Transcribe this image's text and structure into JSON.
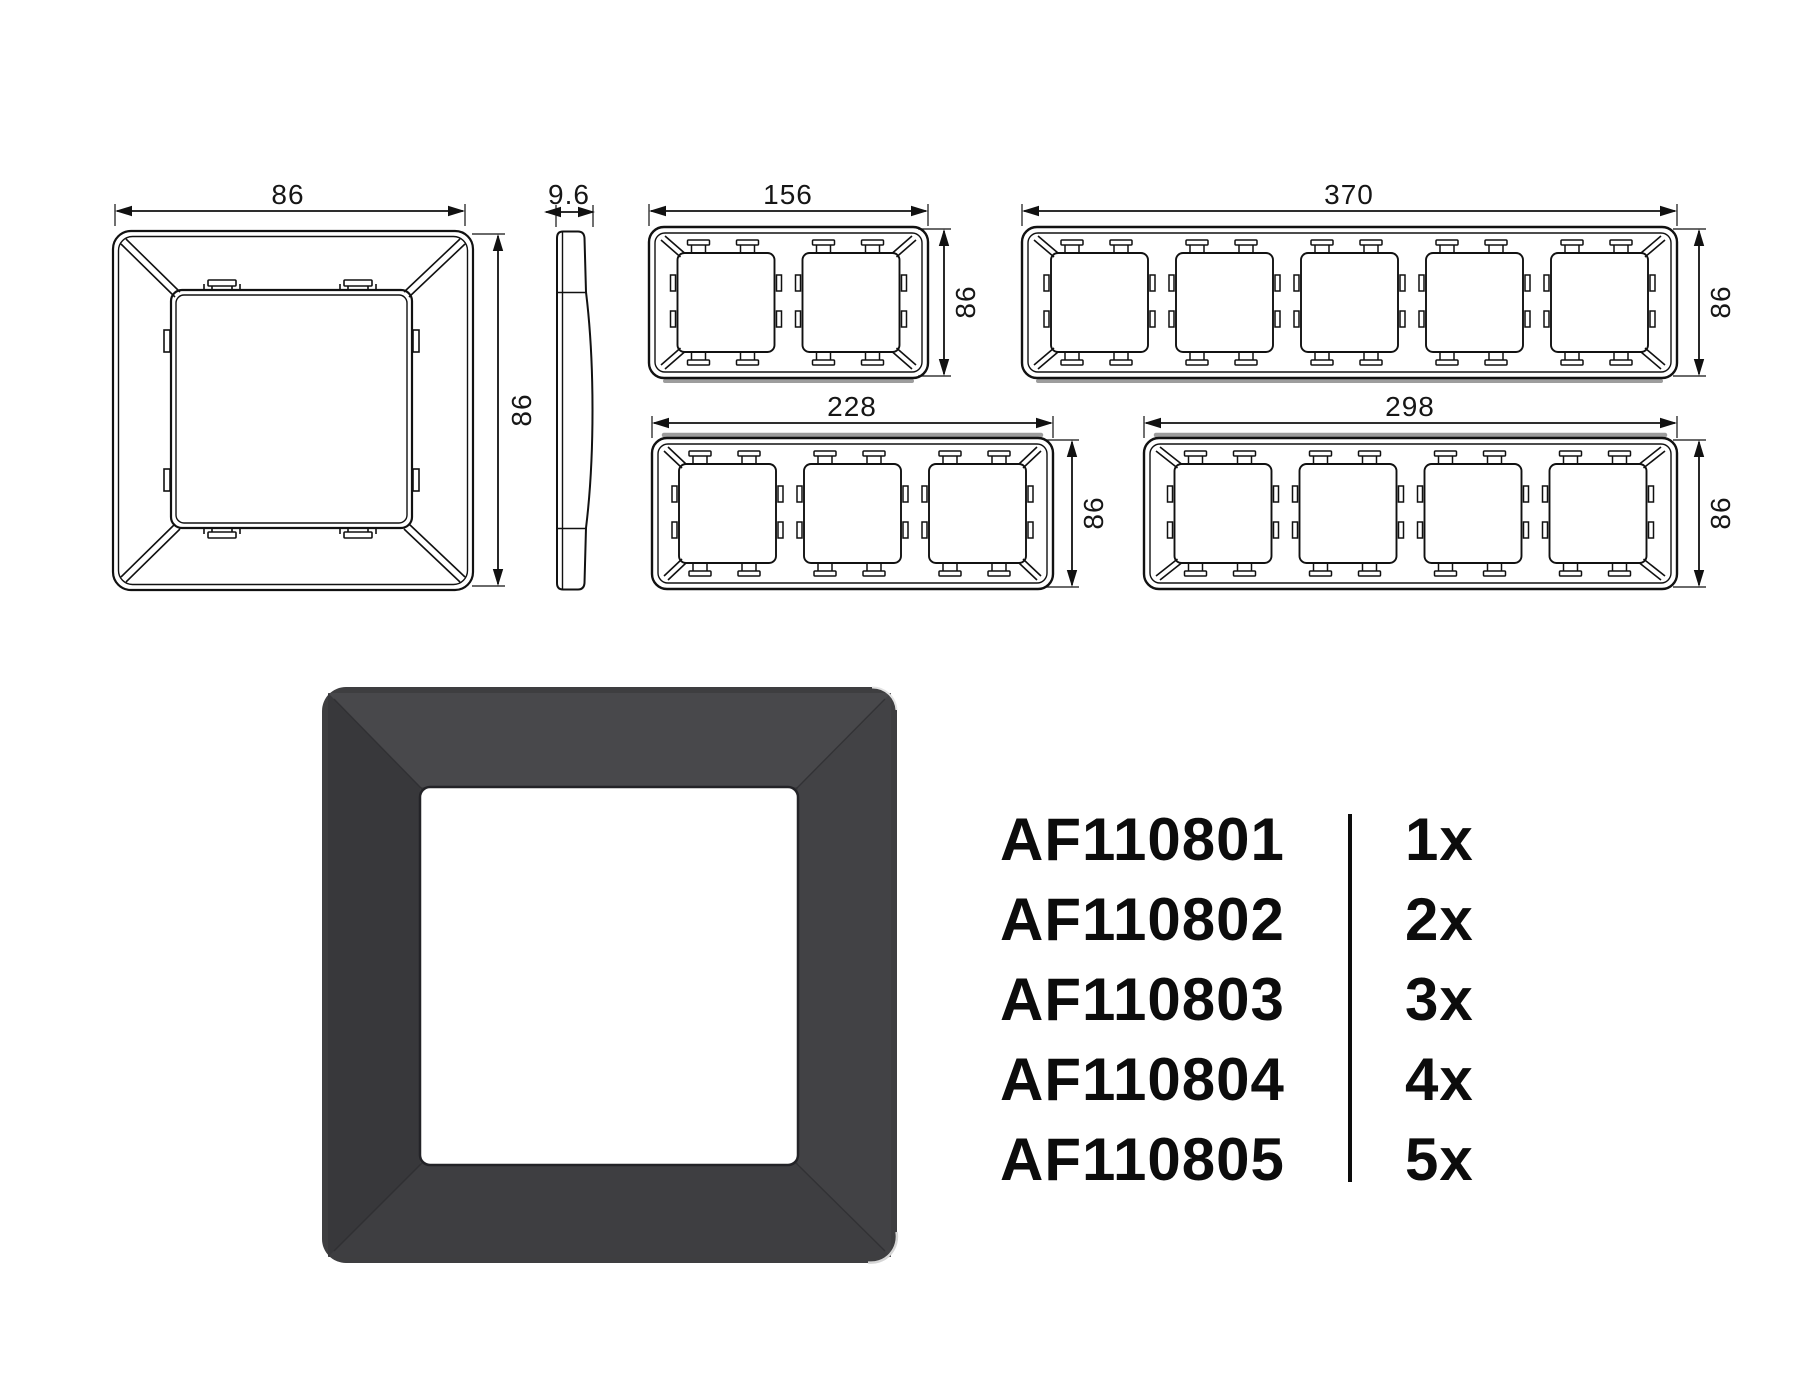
{
  "drawings": {
    "front_view": {
      "width_label": "86",
      "height_label": "86"
    },
    "side_view": {
      "depth_label": "9.6"
    },
    "frame_2gang": {
      "width_label": "156",
      "height_label": "86"
    },
    "frame_3gang": {
      "width_label": "228",
      "height_label": "86"
    },
    "frame_4gang": {
      "width_label": "298",
      "height_label": "86"
    },
    "frame_5gang": {
      "width_label": "370",
      "height_label": "86"
    }
  },
  "render": {
    "frame_color": "#3e3e40",
    "opening_color": "#ffffff"
  },
  "product_table": {
    "rows": [
      {
        "part_number": "AF110801",
        "quantity": "1x"
      },
      {
        "part_number": "AF110802",
        "quantity": "2x"
      },
      {
        "part_number": "AF110803",
        "quantity": "3x"
      },
      {
        "part_number": "AF110804",
        "quantity": "4x"
      },
      {
        "part_number": "AF110805",
        "quantity": "5x"
      }
    ]
  }
}
